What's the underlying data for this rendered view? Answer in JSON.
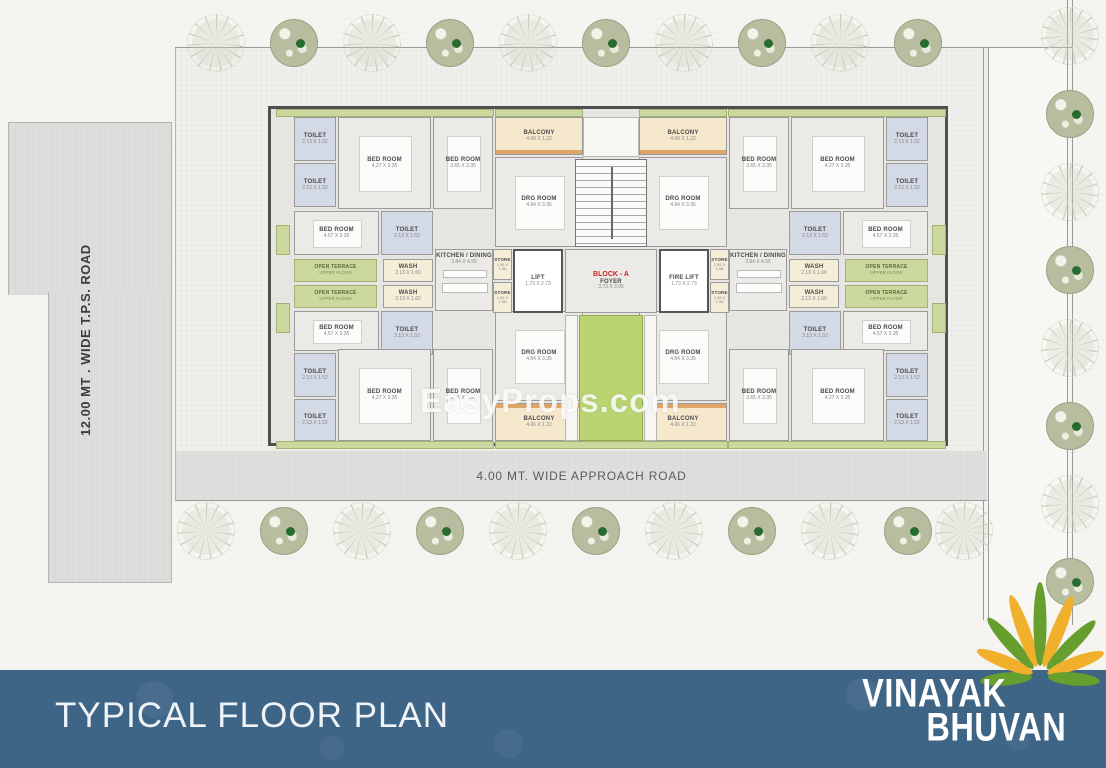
{
  "watermark": "EasyProps.com",
  "roads": {
    "left_vertical": "12.00 MT . WIDE T.P.S. ROAD",
    "bottom": "4.00 MT. WIDE APPROACH ROAD"
  },
  "footer": {
    "title": "TYPICAL FLOOR PLAN",
    "brand_line1": "VINAYAK",
    "brand_line2": "BHUVAN",
    "band_color": "#3e6486",
    "flower_green": "#669f2e",
    "flower_yellow": "#f0b02c"
  },
  "plan": {
    "block_label": "BLOCK - A",
    "colors": {
      "terrace_green": "#cbd99f",
      "lobby_green": "#b9d470",
      "balcony_tan": "#f6e8cc",
      "toilet_blue": "#d3dae5",
      "wash_cream": "#f4edd8",
      "block_label_red": "#c92222"
    },
    "rooms": [
      {
        "t": "strip-green",
        "x": 5,
        "y": 0,
        "w": 218,
        "h": 8
      },
      {
        "t": "strip-green",
        "x": 224,
        "y": 0,
        "w": 88,
        "h": 8
      },
      {
        "t": "strip-green",
        "x": 368,
        "y": 0,
        "w": 88,
        "h": 8
      },
      {
        "t": "strip-green",
        "x": 457,
        "y": 0,
        "w": 218,
        "h": 8
      },
      {
        "t": "strip-green",
        "x": 5,
        "y": 332,
        "w": 218,
        "h": 8
      },
      {
        "t": "strip-green",
        "x": 224,
        "y": 332,
        "w": 233,
        "h": 8
      },
      {
        "t": "strip-green",
        "x": 457,
        "y": 332,
        "w": 218,
        "h": 8
      },
      {
        "t": "edge-green",
        "x": 5,
        "y": 116,
        "w": 14,
        "h": 30
      },
      {
        "t": "edge-green",
        "x": 5,
        "y": 194,
        "w": 14,
        "h": 30
      },
      {
        "t": "edge-green",
        "x": 661,
        "y": 116,
        "w": 14,
        "h": 30
      },
      {
        "t": "edge-green",
        "x": 661,
        "y": 194,
        "w": 14,
        "h": 30
      },
      {
        "t": "toilet",
        "x": 23,
        "y": 8,
        "w": 42,
        "h": 44,
        "name": "TOILET",
        "dims": "2.13 X 1.52"
      },
      {
        "t": "toilet",
        "x": 23,
        "y": 54,
        "w": 42,
        "h": 44,
        "name": "TOILET",
        "dims": "2.13 X 1.52"
      },
      {
        "t": "bed",
        "x": 67,
        "y": 8,
        "w": 93,
        "h": 92,
        "name": "BED ROOM",
        "dims": "4.27 X 3.35"
      },
      {
        "t": "bed",
        "x": 162,
        "y": 8,
        "w": 60,
        "h": 92,
        "name": "BED ROOM",
        "dims": "3.65 X 3.35"
      },
      {
        "t": "balcony",
        "x": 224,
        "y": 8,
        "w": 88,
        "h": 38,
        "name": "BALCONY",
        "dims": "4.06 X 1.22"
      },
      {
        "t": "drg",
        "x": 224,
        "y": 48,
        "w": 88,
        "h": 90,
        "name": "DRG ROOM",
        "dims": "4.84 X 3.35"
      },
      {
        "t": "bed",
        "x": 23,
        "y": 102,
        "w": 85,
        "h": 44,
        "name": "BED ROOM",
        "dims": "4.57 X 3.35"
      },
      {
        "t": "toilet",
        "x": 110,
        "y": 102,
        "w": 52,
        "h": 44,
        "name": "TOILET",
        "dims": "2.13 X 1.52"
      },
      {
        "t": "kitchen",
        "x": 164,
        "y": 140,
        "w": 58,
        "h": 62,
        "name": "KITCHEN / DINING",
        "dims": "3.84 X 4.55"
      },
      {
        "t": "terrace",
        "x": 23,
        "y": 150,
        "w": 83,
        "h": 23,
        "name": "OPEN TERRACE",
        "dims": "UPPER FLOOR"
      },
      {
        "t": "terrace",
        "x": 23,
        "y": 176,
        "w": 83,
        "h": 23,
        "name": "OPEN TERRACE",
        "dims": "UPPER FLOOR"
      },
      {
        "t": "wash",
        "x": 112,
        "y": 150,
        "w": 50,
        "h": 23,
        "name": "WASH",
        "dims": "2.13 X 1.60"
      },
      {
        "t": "wash",
        "x": 112,
        "y": 176,
        "w": 50,
        "h": 23,
        "name": "WASH",
        "dims": "2.13 X 1.60"
      },
      {
        "t": "bed",
        "x": 23,
        "y": 202,
        "w": 85,
        "h": 40,
        "name": "BED ROOM",
        "dims": "4.57 X 3.35"
      },
      {
        "t": "toilet",
        "x": 110,
        "y": 202,
        "w": 52,
        "h": 44,
        "name": "TOILET",
        "dims": "2.13 X 1.52"
      },
      {
        "t": "toilet",
        "x": 23,
        "y": 244,
        "w": 42,
        "h": 44,
        "name": "TOILET",
        "dims": "2.13 X 1.52"
      },
      {
        "t": "toilet",
        "x": 23,
        "y": 290,
        "w": 42,
        "h": 42,
        "name": "TOILET",
        "dims": "2.13 X 1.52"
      },
      {
        "t": "bed",
        "x": 67,
        "y": 240,
        "w": 93,
        "h": 92,
        "name": "BED ROOM",
        "dims": "4.27 X 3.35"
      },
      {
        "t": "bed",
        "x": 162,
        "y": 240,
        "w": 60,
        "h": 92,
        "name": "BED ROOM",
        "dims": "3.65 X 3.35"
      },
      {
        "t": "drg",
        "x": 224,
        "y": 202,
        "w": 88,
        "h": 90,
        "name": "DRG ROOM",
        "dims": "4.84 X 3.35"
      },
      {
        "t": "balcony flip",
        "x": 224,
        "y": 294,
        "w": 88,
        "h": 38,
        "name": "BALCONY",
        "dims": "4.06 X 1.22"
      },
      {
        "t": "toilet",
        "x": 615,
        "y": 8,
        "w": 42,
        "h": 44,
        "name": "TOILET",
        "dims": "2.13 X 1.52"
      },
      {
        "t": "toilet",
        "x": 615,
        "y": 54,
        "w": 42,
        "h": 44,
        "name": "TOILET",
        "dims": "2.13 X 1.52"
      },
      {
        "t": "bed",
        "x": 520,
        "y": 8,
        "w": 93,
        "h": 92,
        "name": "BED ROOM",
        "dims": "4.27 X 3.35"
      },
      {
        "t": "bed",
        "x": 458,
        "y": 8,
        "w": 60,
        "h": 92,
        "name": "BED ROOM",
        "dims": "3.65 X 3.35"
      },
      {
        "t": "balcony",
        "x": 368,
        "y": 8,
        "w": 88,
        "h": 38,
        "name": "BALCONY",
        "dims": "4.06 X 1.22"
      },
      {
        "t": "drg",
        "x": 368,
        "y": 48,
        "w": 88,
        "h": 90,
        "name": "DRG ROOM",
        "dims": "4.84 X 3.35"
      },
      {
        "t": "bed",
        "x": 572,
        "y": 102,
        "w": 85,
        "h": 44,
        "name": "BED ROOM",
        "dims": "4.57 X 3.35"
      },
      {
        "t": "toilet",
        "x": 518,
        "y": 102,
        "w": 52,
        "h": 44,
        "name": "TOILET",
        "dims": "2.13 X 1.52"
      },
      {
        "t": "kitchen",
        "x": 458,
        "y": 140,
        "w": 58,
        "h": 62,
        "name": "KITCHEN / DINING",
        "dims": "3.84 X 4.55"
      },
      {
        "t": "terrace",
        "x": 574,
        "y": 150,
        "w": 83,
        "h": 23,
        "name": "OPEN TERRACE",
        "dims": "UPPER FLOOR"
      },
      {
        "t": "terrace",
        "x": 574,
        "y": 176,
        "w": 83,
        "h": 23,
        "name": "OPEN TERRACE",
        "dims": "UPPER FLOOR"
      },
      {
        "t": "wash",
        "x": 518,
        "y": 150,
        "w": 50,
        "h": 23,
        "name": "WASH",
        "dims": "2.13 X 1.60"
      },
      {
        "t": "wash",
        "x": 518,
        "y": 176,
        "w": 50,
        "h": 23,
        "name": "WASH",
        "dims": "2.13 X 1.60"
      },
      {
        "t": "bed",
        "x": 572,
        "y": 202,
        "w": 85,
        "h": 40,
        "name": "BED ROOM",
        "dims": "4.57 X 3.35"
      },
      {
        "t": "toilet",
        "x": 518,
        "y": 202,
        "w": 52,
        "h": 44,
        "name": "TOILET",
        "dims": "2.13 X 1.52"
      },
      {
        "t": "toilet",
        "x": 615,
        "y": 244,
        "w": 42,
        "h": 44,
        "name": "TOILET",
        "dims": "2.13 X 1.52"
      },
      {
        "t": "toilet",
        "x": 615,
        "y": 290,
        "w": 42,
        "h": 42,
        "name": "TOILET",
        "dims": "2.13 X 1.52"
      },
      {
        "t": "bed",
        "x": 520,
        "y": 240,
        "w": 93,
        "h": 92,
        "name": "BED ROOM",
        "dims": "4.27 X 3.35"
      },
      {
        "t": "bed",
        "x": 458,
        "y": 240,
        "w": 60,
        "h": 92,
        "name": "BED ROOM",
        "dims": "3.65 X 3.35"
      },
      {
        "t": "drg",
        "x": 368,
        "y": 202,
        "w": 88,
        "h": 90,
        "name": "DRG ROOM",
        "dims": "4.84 X 3.35"
      },
      {
        "t": "balcony flip",
        "x": 368,
        "y": 294,
        "w": 88,
        "h": 38,
        "name": "BALCONY",
        "dims": "4.06 X 1.22"
      },
      {
        "t": "plain",
        "x": 312,
        "y": 8,
        "w": 56,
        "h": 40
      },
      {
        "t": "stair",
        "x": 304,
        "y": 50,
        "w": 72,
        "h": 88
      },
      {
        "t": "foyer",
        "x": 294,
        "y": 140,
        "w": 92,
        "h": 64,
        "extra": "BLOCK - A",
        "name": "FOYER",
        "dims": "3.73 X 3.05"
      },
      {
        "t": "lift",
        "x": 242,
        "y": 140,
        "w": 50,
        "h": 64,
        "name": "LIFT",
        "dims": "1.73 X 2.73"
      },
      {
        "t": "lift",
        "x": 388,
        "y": 140,
        "w": 50,
        "h": 64,
        "name": "FIRE LIFT",
        "dims": "1.73 X 2.73"
      },
      {
        "t": "store",
        "x": 222,
        "y": 140,
        "w": 19,
        "h": 31,
        "name": "STORE",
        "dims": "1.06 X 1.98"
      },
      {
        "t": "store",
        "x": 222,
        "y": 173,
        "w": 19,
        "h": 31,
        "name": "STORE",
        "dims": "1.06 X 1.98"
      },
      {
        "t": "store",
        "x": 439,
        "y": 140,
        "w": 19,
        "h": 31,
        "name": "STORE",
        "dims": "1.06 X 1.98"
      },
      {
        "t": "store",
        "x": 439,
        "y": 173,
        "w": 19,
        "h": 31,
        "name": "STORE",
        "dims": "1.06 X 1.98"
      },
      {
        "t": "plain",
        "x": 294,
        "y": 206,
        "w": 13,
        "h": 126
      },
      {
        "t": "plain",
        "x": 373,
        "y": 206,
        "w": 13,
        "h": 126
      },
      {
        "t": "lobby",
        "x": 308,
        "y": 206,
        "w": 64,
        "h": 126
      }
    ]
  },
  "trees": {
    "top": [
      {
        "x": 215,
        "k": "s"
      },
      {
        "x": 293,
        "k": "o"
      },
      {
        "x": 371,
        "k": "s"
      },
      {
        "x": 449,
        "k": "o"
      },
      {
        "x": 527,
        "k": "s"
      },
      {
        "x": 605,
        "k": "o"
      },
      {
        "x": 683,
        "k": "s"
      },
      {
        "x": 761,
        "k": "o"
      },
      {
        "x": 839,
        "k": "s"
      },
      {
        "x": 917,
        "k": "o"
      }
    ],
    "bottom": [
      {
        "x": 205,
        "k": "s"
      },
      {
        "x": 283,
        "k": "o"
      },
      {
        "x": 361,
        "k": "s"
      },
      {
        "x": 439,
        "k": "o"
      },
      {
        "x": 517,
        "k": "s"
      },
      {
        "x": 595,
        "k": "o"
      },
      {
        "x": 673,
        "k": "s"
      },
      {
        "x": 751,
        "k": "o"
      },
      {
        "x": 829,
        "k": "s"
      },
      {
        "x": 907,
        "k": "o"
      },
      {
        "x": 963,
        "k": "s"
      }
    ],
    "right": [
      {
        "y": 35,
        "k": "s"
      },
      {
        "y": 113,
        "k": "o"
      },
      {
        "y": 191,
        "k": "s"
      },
      {
        "y": 269,
        "k": "o"
      },
      {
        "y": 347,
        "k": "s"
      },
      {
        "y": 425,
        "k": "o"
      },
      {
        "y": 503,
        "k": "s"
      },
      {
        "y": 581,
        "k": "o"
      }
    ]
  }
}
